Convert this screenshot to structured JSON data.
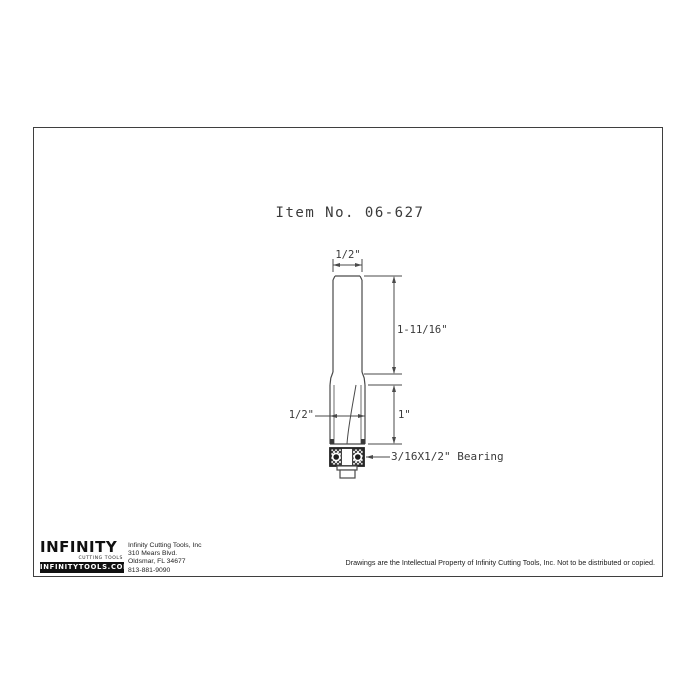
{
  "title": "Item No. 06-627",
  "drawing": {
    "dim_shank_diameter": "1/2\"",
    "dim_shank_length": "1-11/16\"",
    "dim_cutter_diameter": "1/2\"",
    "dim_cutter_length": "1\"",
    "bearing_label": "3/16X1/2\" Bearing"
  },
  "footer": {
    "logo": {
      "name": "INFINITY",
      "tagline": "CUTTING TOOLS",
      "website": "INFINITYTOOLS.COM"
    },
    "address": [
      "Infinity Cutting Tools, Inc",
      "310 Mears Blvd.",
      "Oldsmar, FL  34677",
      "813-881-9090"
    ],
    "copyright": "Drawings are the Intellectual Property of Infinity Cutting Tools, Inc. Not to be distributed or copied."
  },
  "colors": {
    "line": "#4a4a4a",
    "dark_line": "#222222",
    "text": "#3a3a3a",
    "background": "#ffffff"
  }
}
